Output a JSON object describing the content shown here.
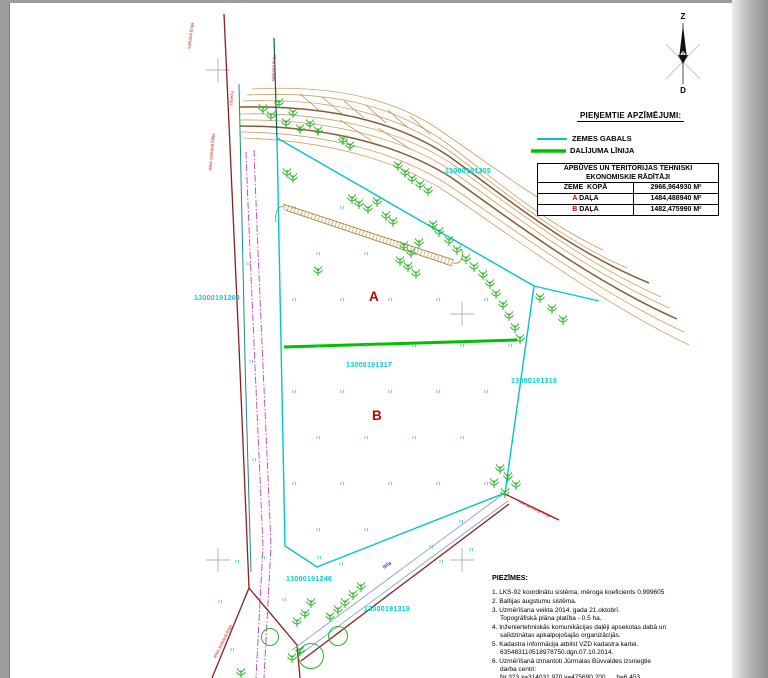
{
  "north": {
    "top": "Z",
    "bottom": "D"
  },
  "legend": {
    "title": "PIEŅEMTIE APZĪMĒJUMI:",
    "items": [
      {
        "label": "ZEMES GABALS"
      },
      {
        "label": "DALĪJUMA LĪNIJA"
      }
    ]
  },
  "table": {
    "header_line1": "APBŪVES UN TERITORIJAS TEHNISKI",
    "header_line2": "EKONOMISKIE RĀDĪTĀJI",
    "rows": [
      {
        "prefix": "",
        "label": "ZEME  KOPĀ",
        "value": "2966,964930 M²"
      },
      {
        "prefix": "A",
        "label": " DAĻA",
        "value": "1484,488940 M²"
      },
      {
        "prefix": "B",
        "label": " DAĻA",
        "value": "1482,475990 M²"
      }
    ]
  },
  "notes": {
    "title": "PIEZĪMES:",
    "lines": [
      "1. LKS-92 koordinātu sistēma, mēroga koeficients 0.999605",
      "2. Baltijas augstumu sistēma.",
      "3. Uzmērīšana veikta 2014. gada 21.oktobrī.",
      "Topogrāfiskā plāna platība - 0.5 ha.",
      "4. Inženiertehniskās komunikācijas daļēji apsekotas dabā un",
      "salīdzinātas apkalpojošajās organizācijās.",
      "5. Kadastra informācija atbilst VZD kadastra kartei.",
      "635483110518978750.dgn.07.10.2014.",
      "6. Uzmērīšanā izmantoti Jūrmalas Būvvaldes izsniegtie",
      "darba centri:",
      "Nr.323 x=314031.970 y=475690.200      h=6.453"
    ]
  },
  "map": {
    "part_a": "A",
    "part_b": "B",
    "cadastral_numbers": [
      "13000191305",
      "13000191203",
      "13000191317",
      "13000191318",
      "13000191246",
      "13000191319"
    ],
    "annotations": {
      "red_line_nw": "ielas sarkanā līnija",
      "red_line_top": "sarkanā līnija",
      "boundary_label": "robeža",
      "fence_label": "sarkanā līnija",
      "red_line_sw": "ielas sarkanā līnija",
      "red_line_se": "iela sarkanā līnija",
      "road_name": "iela"
    }
  },
  "colors": {
    "parcel_line": "#00c6c6",
    "division_line": "#00c000",
    "contour": "#c9a263",
    "contour_index": "#8b5a2b",
    "red_line": "#8b1e1e",
    "vegetation": "#2ab42a",
    "utility_magenta": "#c040c0",
    "road_line": "#8fa0c8",
    "label_cyan": "#00d2d2",
    "label_red": "#c00000"
  }
}
